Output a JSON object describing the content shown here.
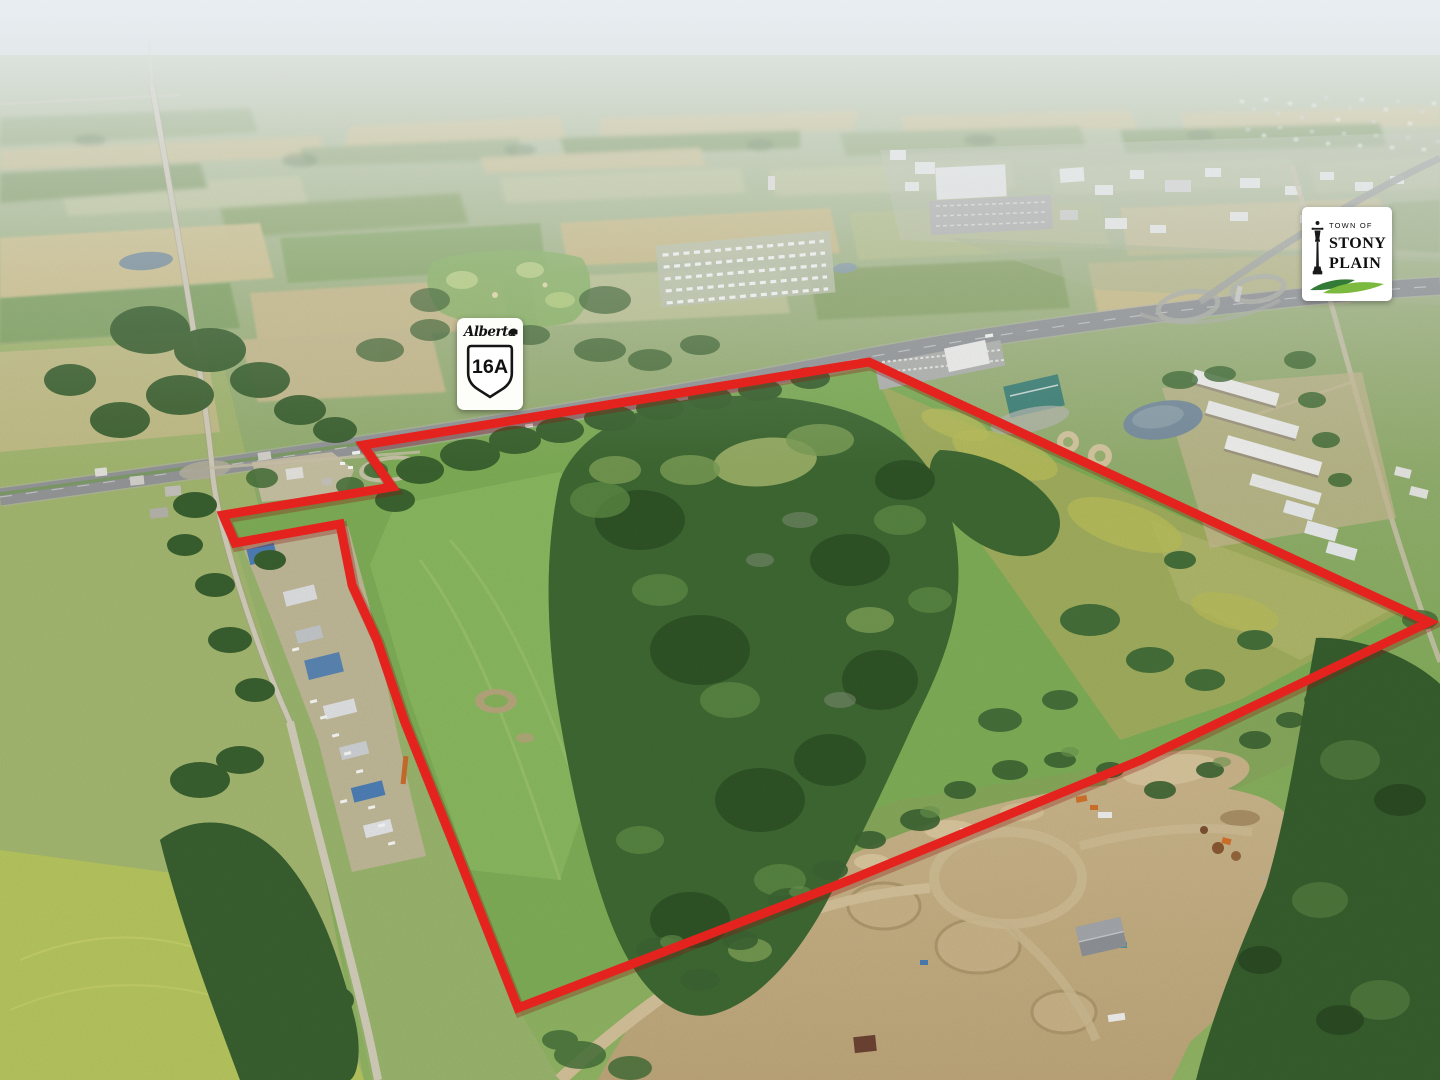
{
  "overlays": {
    "highway_shield": {
      "province_script": "Alberta",
      "route_number": "16A"
    },
    "town_logo": {
      "line_top": "TOWN OF",
      "line_name_1": "STONY",
      "line_name_2": "PLAIN"
    }
  },
  "parcel_boundary": {
    "stroke_color": "#e5231e",
    "stroke_width": "9",
    "points": "363,445 392,487 223,515 235,543 340,524 352,585 377,640 404,720 452,840 518,1008 850,880 1141,760 1429,622 869,362"
  },
  "palette": {
    "sky_haze": "#e9eef0",
    "field_wheat": "#d4c590",
    "field_green": "#8fae6d",
    "pasture_green": "#84b35c",
    "forest_green": "#3f6a33",
    "dirt_tan": "#c9b286",
    "highway_gray": "#97999b",
    "logo_green_dark": "#337a36",
    "logo_green_light": "#7cb93f"
  },
  "icons": {
    "lamppost": "lamppost-icon",
    "alberta_flag": "alberta-flag-icon",
    "route_shield": "route-shield-icon"
  }
}
